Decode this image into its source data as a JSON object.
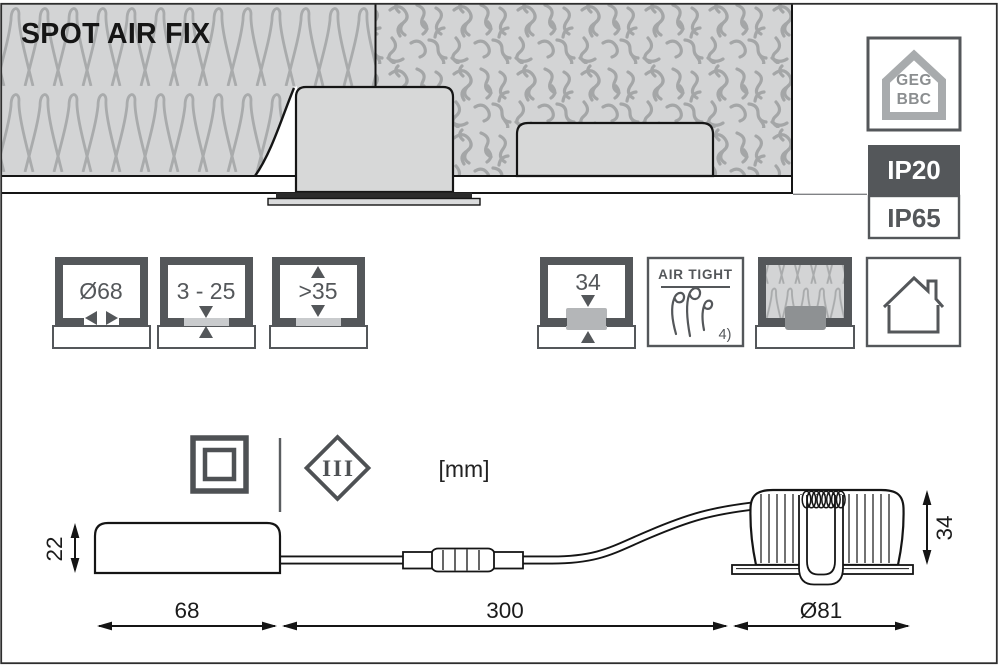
{
  "title": "SPOT AIR FIX",
  "badges": {
    "geg_bbc": {
      "line1": "GEG",
      "line2": "BBC",
      "icon": "house-outline-icon"
    },
    "ip_above_ceiling": "IP20",
    "ip_below_ceiling": "IP65"
  },
  "spec_icons": {
    "cutout_diameter": {
      "label": "Ø68",
      "icon": "cutout-diameter-icon"
    },
    "ceiling_thickness": {
      "label": "3 - 25",
      "icon": "ceiling-thickness-icon"
    },
    "clearance_above": {
      "label": ">35",
      "icon": "clearance-above-icon"
    },
    "recess_height": {
      "label": "34",
      "icon": "recess-height-icon"
    },
    "air_tight": {
      "label": "AIR TIGHT",
      "footnote": "4)",
      "icon": "air-flow-icon"
    },
    "insulation_contact": {
      "icon": "insulation-pattern-icon"
    },
    "indoor_use": {
      "icon": "indoor-house-icon"
    }
  },
  "class_marks": {
    "protection_class_2_icon": "double-square-icon",
    "protection_class_3": "III"
  },
  "units_label": "[mm]",
  "dimensions": {
    "driver_height": "22",
    "driver_length": "68",
    "cable_length": "300",
    "spot_diameter": "Ø81",
    "spot_height": "34"
  },
  "colors": {
    "icon_dark_gray": "#54575a",
    "drawing_black": "#1a1a1a",
    "insulation_gray": "#d3d4d5",
    "badge_ip20_bg": "#54575a"
  }
}
